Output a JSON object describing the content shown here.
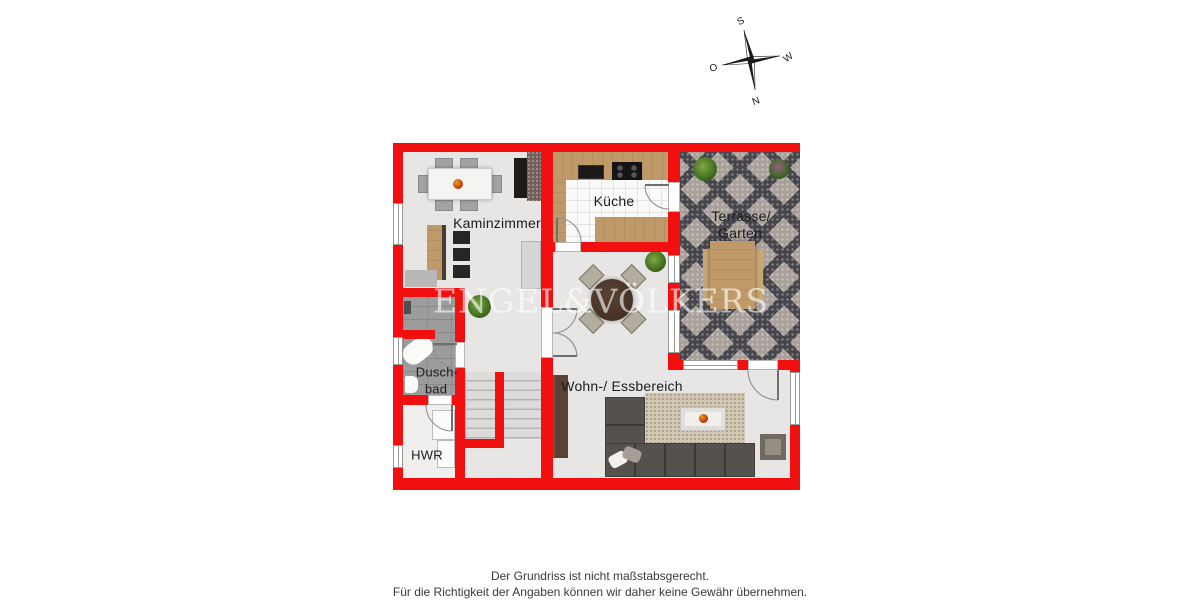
{
  "watermark": "ENGEL&VÖLKERS",
  "compass": {
    "north": "N",
    "south": "S",
    "east": "O",
    "west": "W"
  },
  "rooms": {
    "kaminzimmer": {
      "label": "Kaminzimmer"
    },
    "kueche": {
      "label": "Küche"
    },
    "terrasse": {
      "label_line1": "Terrasse/",
      "label_line2": "Garten"
    },
    "wohnbereich": {
      "label": "Wohn-/ Essbereich"
    },
    "duschbad": {
      "label_line1": "Dusch-",
      "label_line2": "bad"
    },
    "hwr": {
      "label": "HWR"
    }
  },
  "footer": {
    "line1": "Der Grundriss ist nicht maßstabsgerecht.",
    "line2": "Für die Richtigkeit der Angaben können wir daher keine Gewähr übernehmen."
  },
  "colors": {
    "wall_red": "#f10f0f",
    "floor_gray": "#e7e6e4",
    "terrace_dark": "#46454b",
    "terrace_light": "#a9a199",
    "wood": "#bf9a68",
    "sofa_gray": "#55514d",
    "watermark_white": "rgba(255,255,255,0.62)"
  }
}
